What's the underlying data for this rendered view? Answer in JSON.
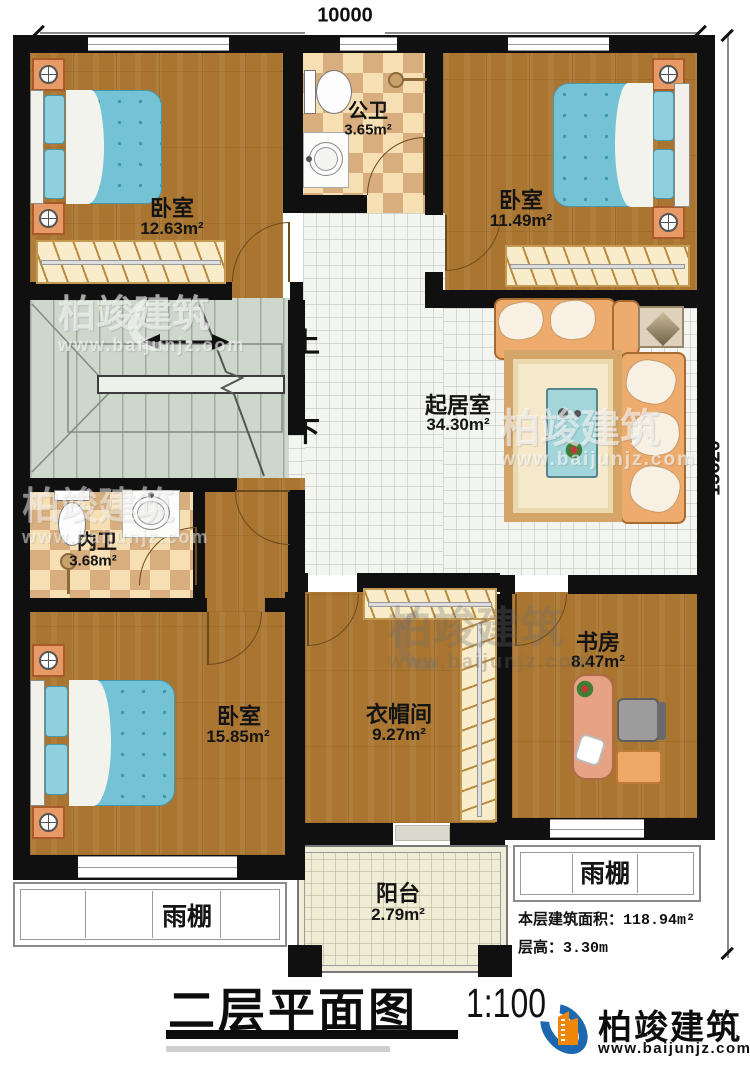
{
  "title": {
    "name": "二层平面图",
    "scale": "1:100"
  },
  "brand": {
    "name": "柏竣建筑",
    "url": "www.baijunjz.com"
  },
  "watermark": {
    "name": "柏竣建筑",
    "url": "www.baijunjz.com"
  },
  "dimensions": {
    "top": "10000",
    "right": "13620"
  },
  "info": {
    "area_label": "本层建筑面积：",
    "area_value": "118.94m²",
    "floor_height_label": "层高：",
    "floor_height_value": "3.30m"
  },
  "stairs": {
    "up": "上",
    "down": "下"
  },
  "rooms": {
    "bedroom_top_left": {
      "label": "卧室",
      "area": "12.63m²"
    },
    "public_bath": {
      "label": "公卫",
      "area": "3.65m²"
    },
    "bedroom_top_right": {
      "label": "卧室",
      "area": "11.49m²"
    },
    "living_room": {
      "label": "起居室",
      "area": "34.30m²"
    },
    "inner_bath": {
      "label": "内卫",
      "area": "3.68m²"
    },
    "bedroom_bottom_left": {
      "label": "卧室",
      "area": "15.85m²"
    },
    "cloakroom": {
      "label": "衣帽间",
      "area": "9.27m²"
    },
    "study": {
      "label": "书房",
      "area": "8.47m²"
    },
    "balcony": {
      "label": "阳台",
      "area": "2.79m²"
    },
    "canopy_left": {
      "label": "雨棚"
    },
    "canopy_right": {
      "label": "雨棚"
    }
  },
  "colors": {
    "wall": "#101010",
    "wood": "#a97530",
    "tile": "#f3f5f0",
    "checker_light": "#f5dfb3",
    "checker_dark": "#d8ae7e",
    "stair": "#cdd7cb",
    "bed": "#74c3d5",
    "accent_sofa": "#edab6e",
    "brand_blue": "#1b67b0",
    "brand_orange": "#ef8606"
  }
}
